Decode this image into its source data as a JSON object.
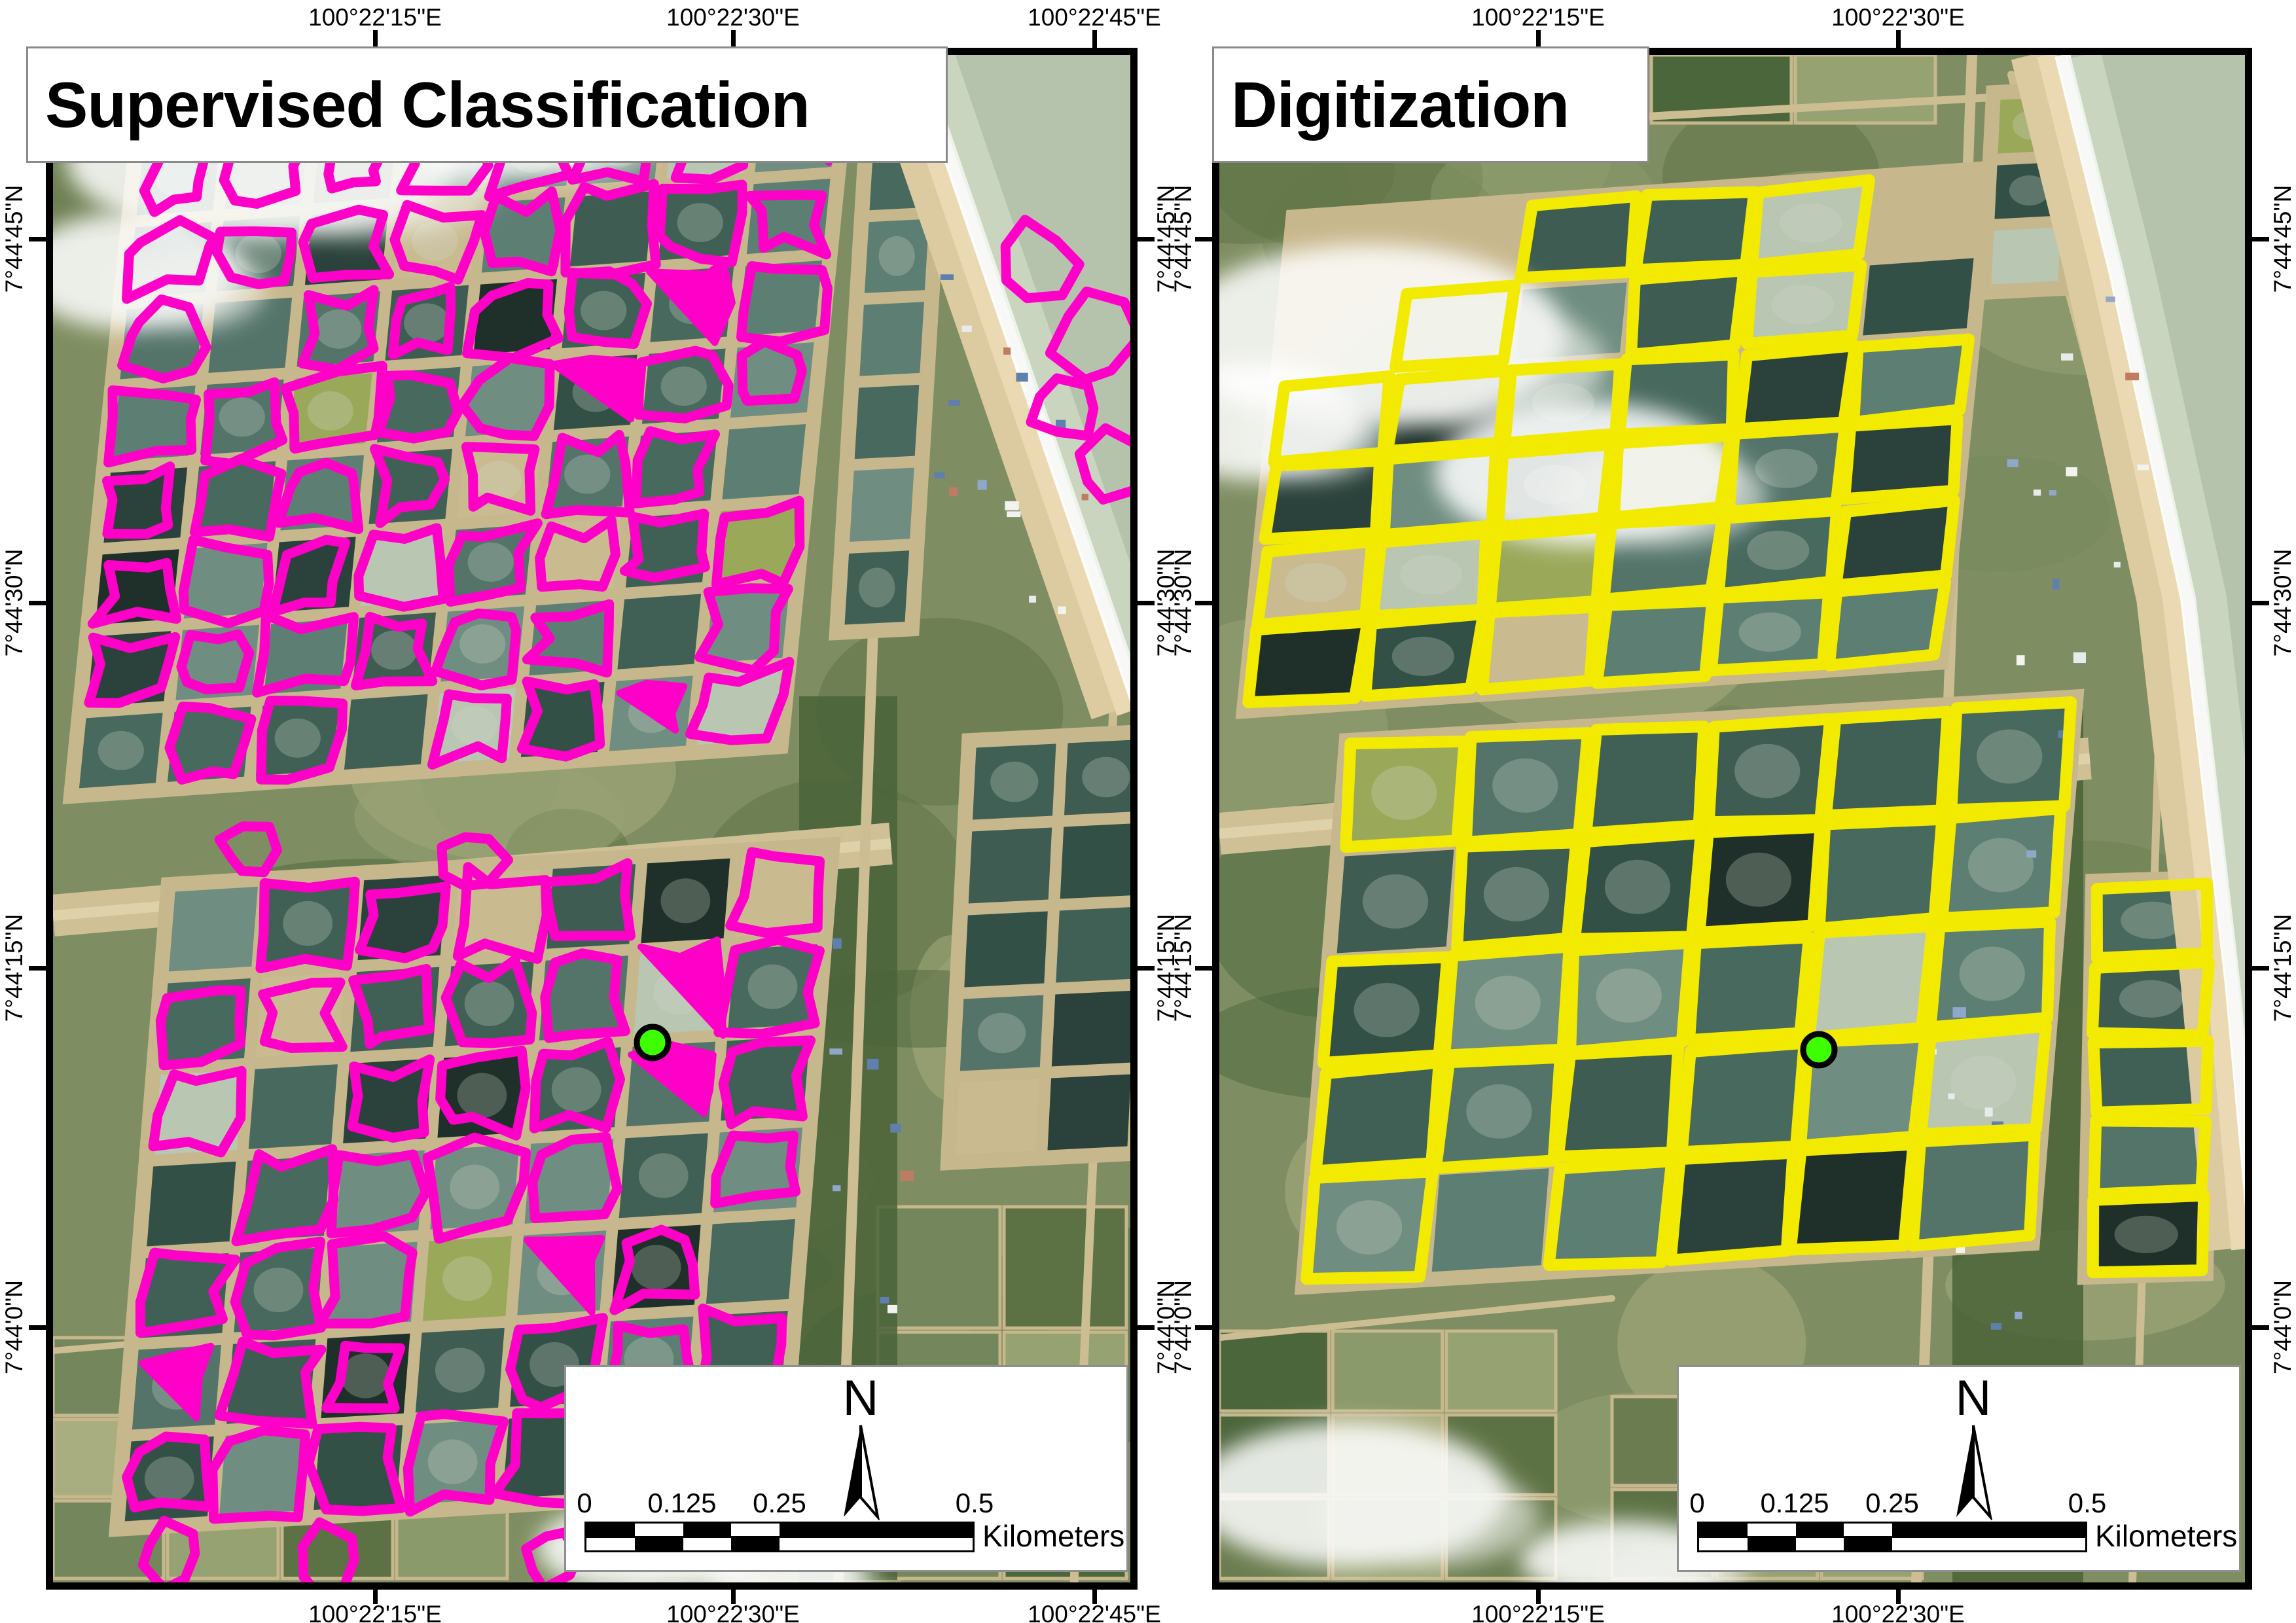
{
  "figure": {
    "type": "map-comparison-figure",
    "panel_count": 2
  },
  "maps": {
    "left": {
      "title": "Supervised Classification",
      "outline_color": "#FF00C8",
      "lon_labels": [
        "100°22'15\"E",
        "100°22'30\"E",
        "100°22'45\"E"
      ]
    },
    "right": {
      "title": "Digitization",
      "outline_color": "#F2EA00",
      "lon_labels": [
        "100°22'15\"E",
        "100°22'30\"E"
      ]
    }
  },
  "lat_labels": [
    "7°44'45\"N",
    "7°44'30\"N",
    "7°44'15\"N",
    "7°44'0\"N"
  ],
  "marker": {
    "color": "#3DFF00",
    "outline": "#000000"
  },
  "scale_bar": {
    "ticks": [
      "0",
      "0.125",
      "0.25",
      "0.5"
    ],
    "unit": "Kilometers",
    "north": "N"
  }
}
